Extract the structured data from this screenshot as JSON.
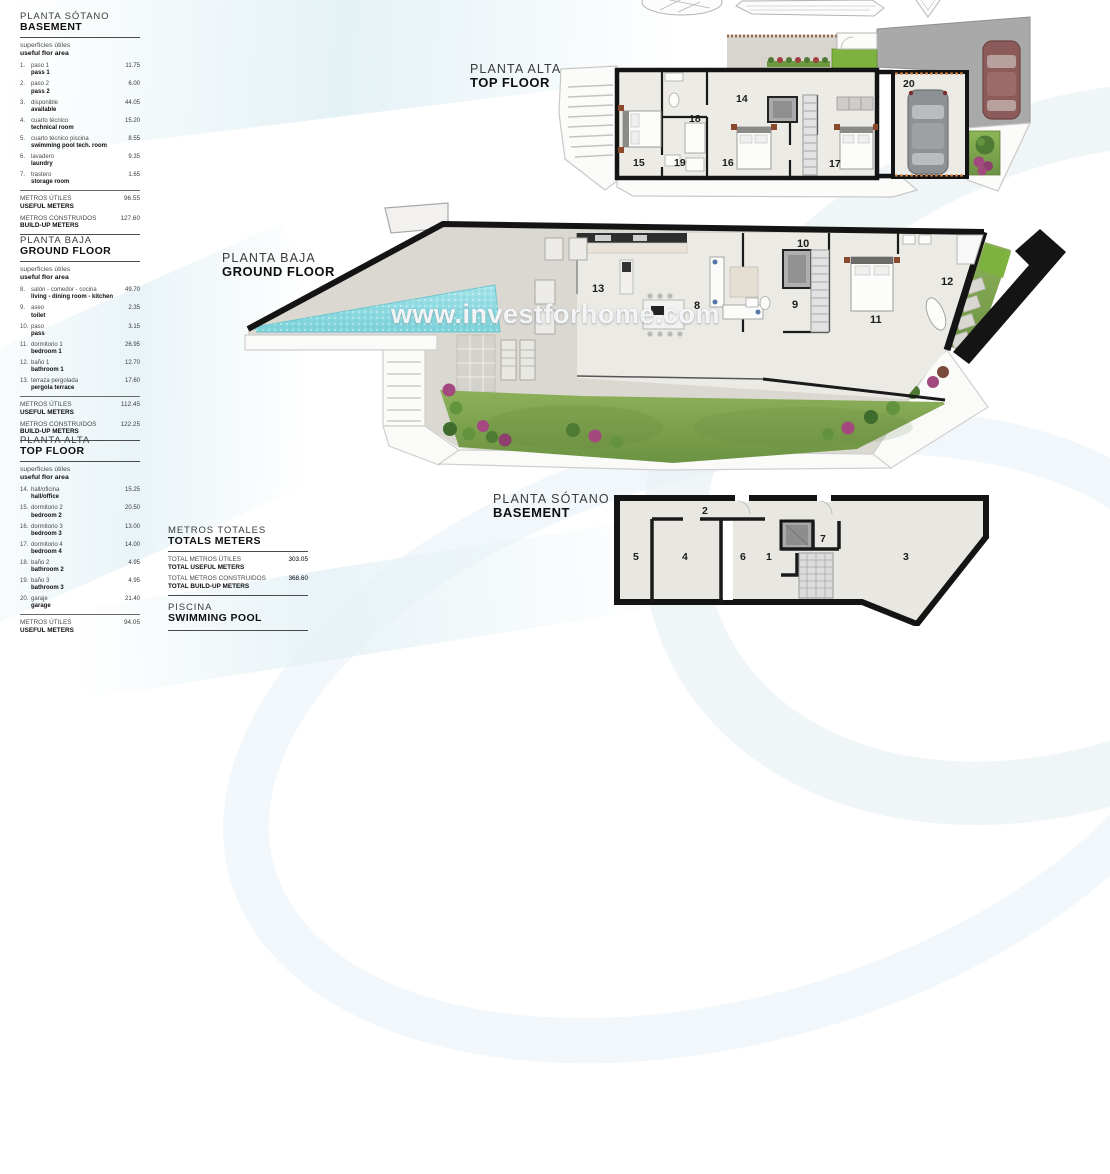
{
  "watermark": "www.investforhome.com",
  "colors": {
    "wall_black": "#141414",
    "pool": "#8FD9E0",
    "lawn": "#7DB23F",
    "garden": "#7CA14B",
    "terrace": "#DBD8D2",
    "interior_floor": "#ECEAE5",
    "driveway": "#A9A9A9",
    "car_red": "#8C5B59",
    "car_grey": "#8E9194",
    "bush_pink": "#A3497F",
    "swoosh_blue": "#E3EFF3",
    "planter_dash": "#9A6B4F"
  },
  "plan_labels": {
    "top": {
      "es": "PLANTA ALTA",
      "en": "TOP FLOOR"
    },
    "ground": {
      "es": "PLANTA BAJA",
      "en": "GROUND FLOOR"
    },
    "basement": {
      "es": "PLANTA SÓTANO",
      "en": "BASEMENT"
    }
  },
  "tables": {
    "basement": {
      "title_es": "PLANTA SÓTANO",
      "title_en": "BASEMENT",
      "subtitle_es": "superficies útiles",
      "subtitle_en": "useful flor area",
      "rows": [
        {
          "num": "1.",
          "es": "paso 1",
          "en": "pass 1",
          "value": "11.75"
        },
        {
          "num": "2.",
          "es": "paso 2",
          "en": "pass 2",
          "value": "6.00"
        },
        {
          "num": "3.",
          "es": "disponible",
          "en": "available",
          "value": "44.05"
        },
        {
          "num": "4.",
          "es": "cuarto técnico",
          "en": "technical room",
          "value": "15.20"
        },
        {
          "num": "5.",
          "es": "cuarto técnico piscina",
          "en": "swimming pool tech. room",
          "value": "8.55"
        },
        {
          "num": "6.",
          "es": "lavadero",
          "en": "laundry",
          "value": "9.35"
        },
        {
          "num": "7.",
          "es": "trastero",
          "en": "storage room",
          "value": "1.65"
        }
      ],
      "totals": [
        {
          "es": "METROS ÚTILES",
          "en": "USEFUL METERS",
          "value": "96.55"
        },
        {
          "es": "METROS CONSTRUIDOS",
          "en": "BUILD-UP METERS",
          "value": "127.60"
        }
      ]
    },
    "ground": {
      "title_es": "PLANTA BAJA",
      "title_en": "GROUND FLOOR",
      "subtitle_es": "superficies útiles",
      "subtitle_en": "useful flor area",
      "rows": [
        {
          "num": "8.",
          "es": "salón - comedor - cocina",
          "en": "living - dining room - kitchen",
          "value": "49.70"
        },
        {
          "num": "9.",
          "es": "aseo",
          "en": "toilet",
          "value": "2.35"
        },
        {
          "num": "10.",
          "es": "paso",
          "en": "pass",
          "value": "3.15"
        },
        {
          "num": "11.",
          "es": "dormitorio 1",
          "en": "bedroom 1",
          "value": "26.95"
        },
        {
          "num": "12.",
          "es": "baño 1",
          "en": "bathroom 1",
          "value": "12.70"
        },
        {
          "num": "13.",
          "es": "terraza pergolada",
          "en": "pergola terrace",
          "value": "17.60"
        }
      ],
      "totals": [
        {
          "es": "METROS ÚTILES",
          "en": "USEFUL METERS",
          "value": "112.45"
        },
        {
          "es": "METROS CONSTRUIDOS",
          "en": "BUILD-UP METERS",
          "value": "122.25"
        }
      ]
    },
    "top": {
      "title_es": "PLANTA ALTA",
      "title_en": "TOP FLOOR",
      "subtitle_es": "superficies útiles",
      "subtitle_en": "useful flor area",
      "rows": [
        {
          "num": "14.",
          "es": "hall/oficina",
          "en": "hall/office",
          "value": "15.25"
        },
        {
          "num": "15.",
          "es": "dormitorio 2",
          "en": "bedroom 2",
          "value": "20.50"
        },
        {
          "num": "16.",
          "es": "dormitorio 3",
          "en": "bedroom 3",
          "value": "13.00"
        },
        {
          "num": "17.",
          "es": "dormitorio 4",
          "en": "bedroom 4",
          "value": "14.00"
        },
        {
          "num": "18.",
          "es": "baño 2",
          "en": "bathroom 2",
          "value": "4.95"
        },
        {
          "num": "19.",
          "es": "baño 3",
          "en": "bathroom 3",
          "value": "4.95"
        },
        {
          "num": "20.",
          "es": "garaje",
          "en": "garage",
          "value": "21.40"
        }
      ],
      "totals": [
        {
          "es": "METROS ÚTILES",
          "en": "USEFUL METERS",
          "value": "94.05"
        }
      ]
    }
  },
  "totals_block": {
    "title_es": "METROS TOTALES",
    "title_en": "TOTALS METERS",
    "rows": [
      {
        "es": "TOTAL METROS ÚTILES",
        "en": "TOTAL USEFUL METERS",
        "value": "303.05"
      },
      {
        "es": "TOTAL METROS CONSTRUIDOS",
        "en": "TOTAL BUILD-UP METERS",
        "value": "368.60"
      }
    ],
    "pool_es": "PISCINA",
    "pool_en": "SWIMMING POOL"
  },
  "plans": {
    "top_floor": {
      "rooms": {
        "r14": "14",
        "r15": "15",
        "r16": "16",
        "r17": "17",
        "r18": "18",
        "r19": "19",
        "r20": "20"
      }
    },
    "ground_floor": {
      "rooms": {
        "r8": "8",
        "r9": "9",
        "r10": "10",
        "r11": "11",
        "r12": "12",
        "r13": "13"
      }
    },
    "basement": {
      "rooms": {
        "r1": "1",
        "r2": "2",
        "r3": "3",
        "r4": "4",
        "r5": "5",
        "r6": "6",
        "r7": "7"
      }
    }
  }
}
